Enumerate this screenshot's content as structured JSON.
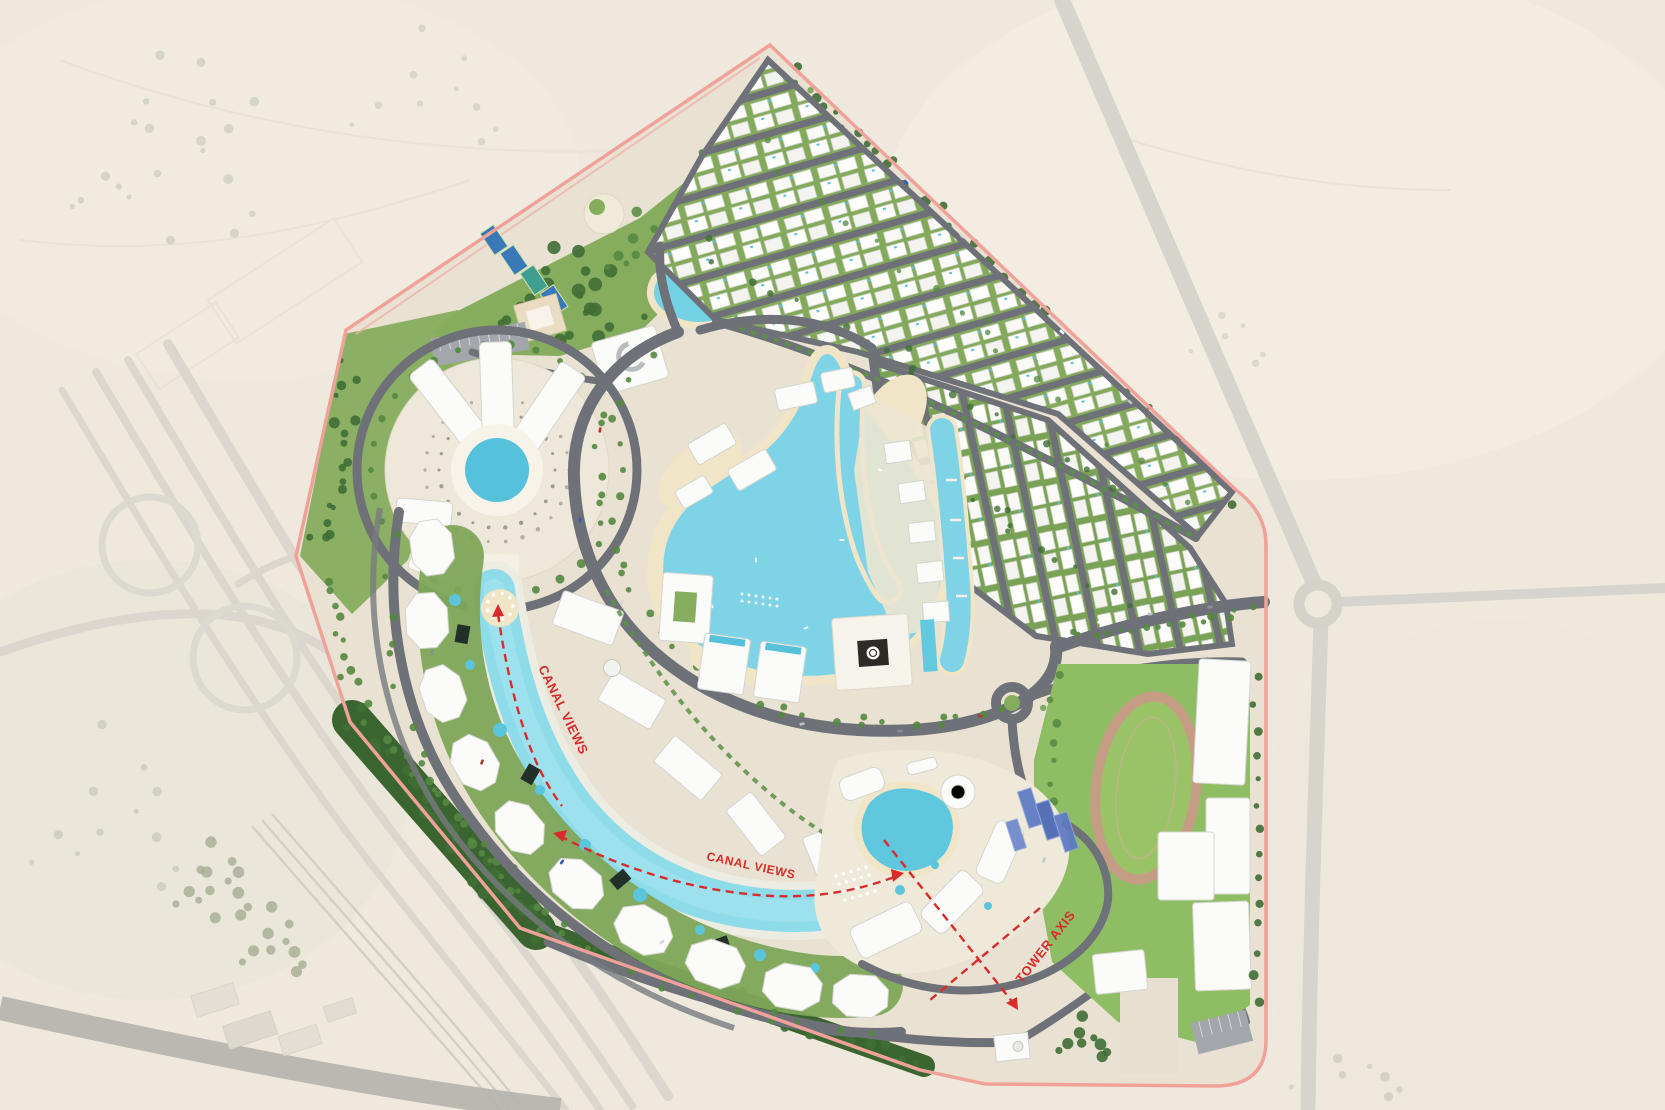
{
  "annotations": {
    "canal_views_label": "CANAL VIEWS",
    "tower_axis_label": "TOWER AXIS"
  },
  "colors": {
    "desert_sand": "#ece5d8",
    "faded_road": "#c6c4be",
    "road_gray": "#6e7278",
    "site_boundary_pink": "#f0a29a",
    "lawn_green": "#86ad5e",
    "tree_green": "#3f6e35",
    "building_white": "#fbfbf9",
    "beach_sand": "#f1e5c8",
    "lagoon_water": "#7ed3e6",
    "canal_water": "#8edbea",
    "pool_water": "#55c1da",
    "glass_tower_blue": "#5d79c4",
    "annotation_red": "#d92b2b",
    "track_tan": "#c59d85",
    "court_blue": "#3a79b8"
  }
}
